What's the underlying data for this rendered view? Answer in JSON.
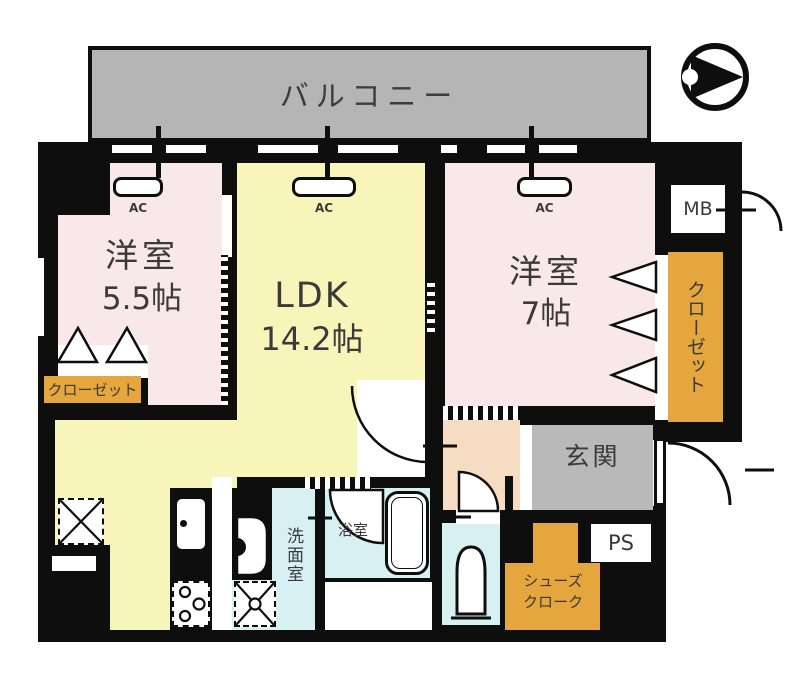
{
  "plan": {
    "balcony": "バルコニー",
    "room_west1": {
      "name": "洋室",
      "size": "5.5帖"
    },
    "ldk": {
      "name": "LDK",
      "size": "14.2帖"
    },
    "room_west2": {
      "name": "洋室",
      "size": "7帖"
    },
    "entrance": "玄関",
    "washroom": "洗面室",
    "bathroom": "浴室",
    "closet_left": "クローゼット",
    "closet_right": "クローゼット",
    "shoes_closet": {
      "line1": "シューズ",
      "line2": "クローク"
    },
    "meter_box": "MB",
    "pipe_space": "PS",
    "ac": "AC"
  },
  "colors": {
    "wall": "#0e0e0e",
    "balcony_gray": "#b5b5b5",
    "entrance_gray": "#b9b9b9",
    "bedroom_pink": "#f9e8ea",
    "ldk_yellow": "#f8f5bb",
    "wet_area_blue": "#d7f0f2",
    "hall_peach": "#f6dcc2",
    "closet_orange": "#e6a63e"
  }
}
